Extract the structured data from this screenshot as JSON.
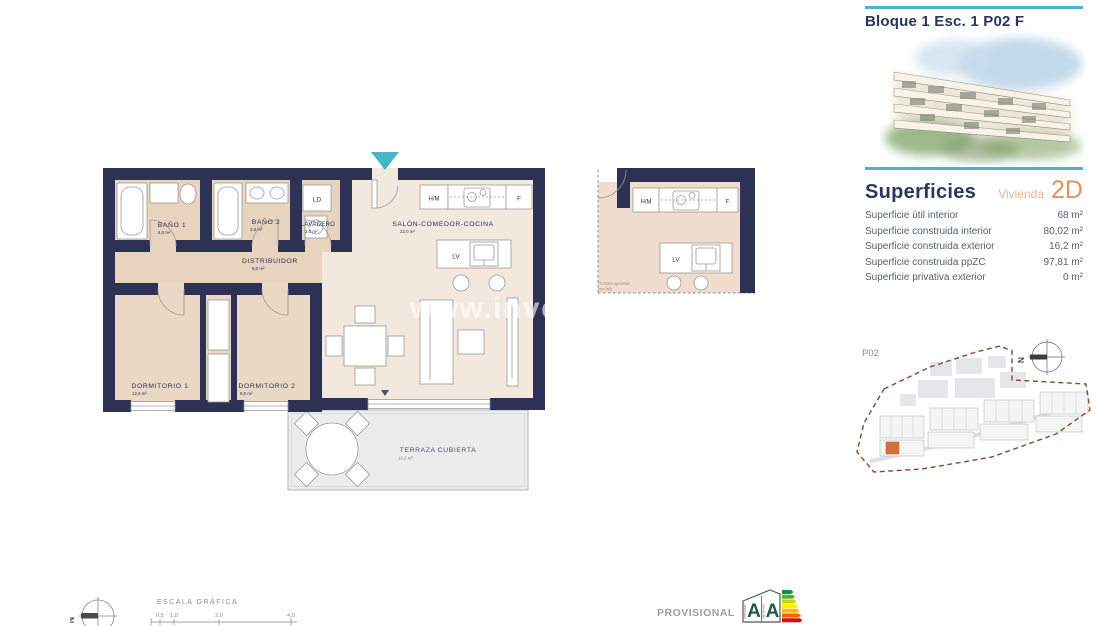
{
  "header": {
    "title": "Bloque 1 Esc. 1 P02 F"
  },
  "superficies": {
    "title": "Superficies",
    "vivienda_label": "Vivienda",
    "vivienda_type": "2D",
    "rows": [
      {
        "label": "Superficie útil interior",
        "value": "68 m²"
      },
      {
        "label": "Superficie construida interior",
        "value": "80,02 m²"
      },
      {
        "label": "Superficie construida exterior",
        "value": "16,2 m²"
      },
      {
        "label": "Superficie construida ppZC",
        "value": "97,81 m²"
      },
      {
        "label": "Superficie privativa exterior",
        "value": "0 m²"
      }
    ]
  },
  "floorplan": {
    "rooms": [
      {
        "name": "BAÑO 1",
        "area": "5,0 m²"
      },
      {
        "name": "BAÑO 2",
        "area": "3,9 m²"
      },
      {
        "name": "LAVADERO",
        "area": "3,0 m²"
      },
      {
        "name": "SALÓN-COMEDOR-COCINA",
        "area": "32,0 m²"
      },
      {
        "name": "DISTRIBUIDOR",
        "area": "5,0 m²"
      },
      {
        "name": "DORMITORIO 1",
        "area": "12,6 m²"
      },
      {
        "name": "DORMITORIO 2",
        "area": "8,8 m²"
      },
      {
        "name": "TERRAZA CUBIERTA",
        "area": "16,2 m²"
      }
    ],
    "fixtures": {
      "ld": "LD",
      "hm": "H/M",
      "f": "F",
      "lv": "LV"
    },
    "watermark": "www.inves"
  },
  "kitchen_detail": {
    "hm": "H/M",
    "f": "F",
    "lv": "LV",
    "note_line1": "*Cocina opcional",
    "note_line2": "con isla"
  },
  "site_plan": {
    "label": "P02",
    "north": "N"
  },
  "footer": {
    "north": "N",
    "scale_title": "ESCALA GRÁFICA",
    "scale_ticks": [
      "0,5",
      "1,0",
      "2,0",
      "4,0"
    ],
    "provisional": "PROVISIONAL",
    "energy": {
      "letter_consumo": "A",
      "letter_emisiones": "A",
      "consumo": "CONSUMO",
      "emisiones": "EMISIONES"
    }
  },
  "colors": {
    "wall_navy": "#2d3153",
    "accent_teal": "#4ab5c6",
    "accent_orange": "#e0915f",
    "room_beige": "#e8d3be",
    "salon_cream": "#f3e8dd",
    "terrace_gray": "#ececec",
    "site_boundary_red": "#8a4538",
    "site_unit_orange": "#d4703a"
  }
}
